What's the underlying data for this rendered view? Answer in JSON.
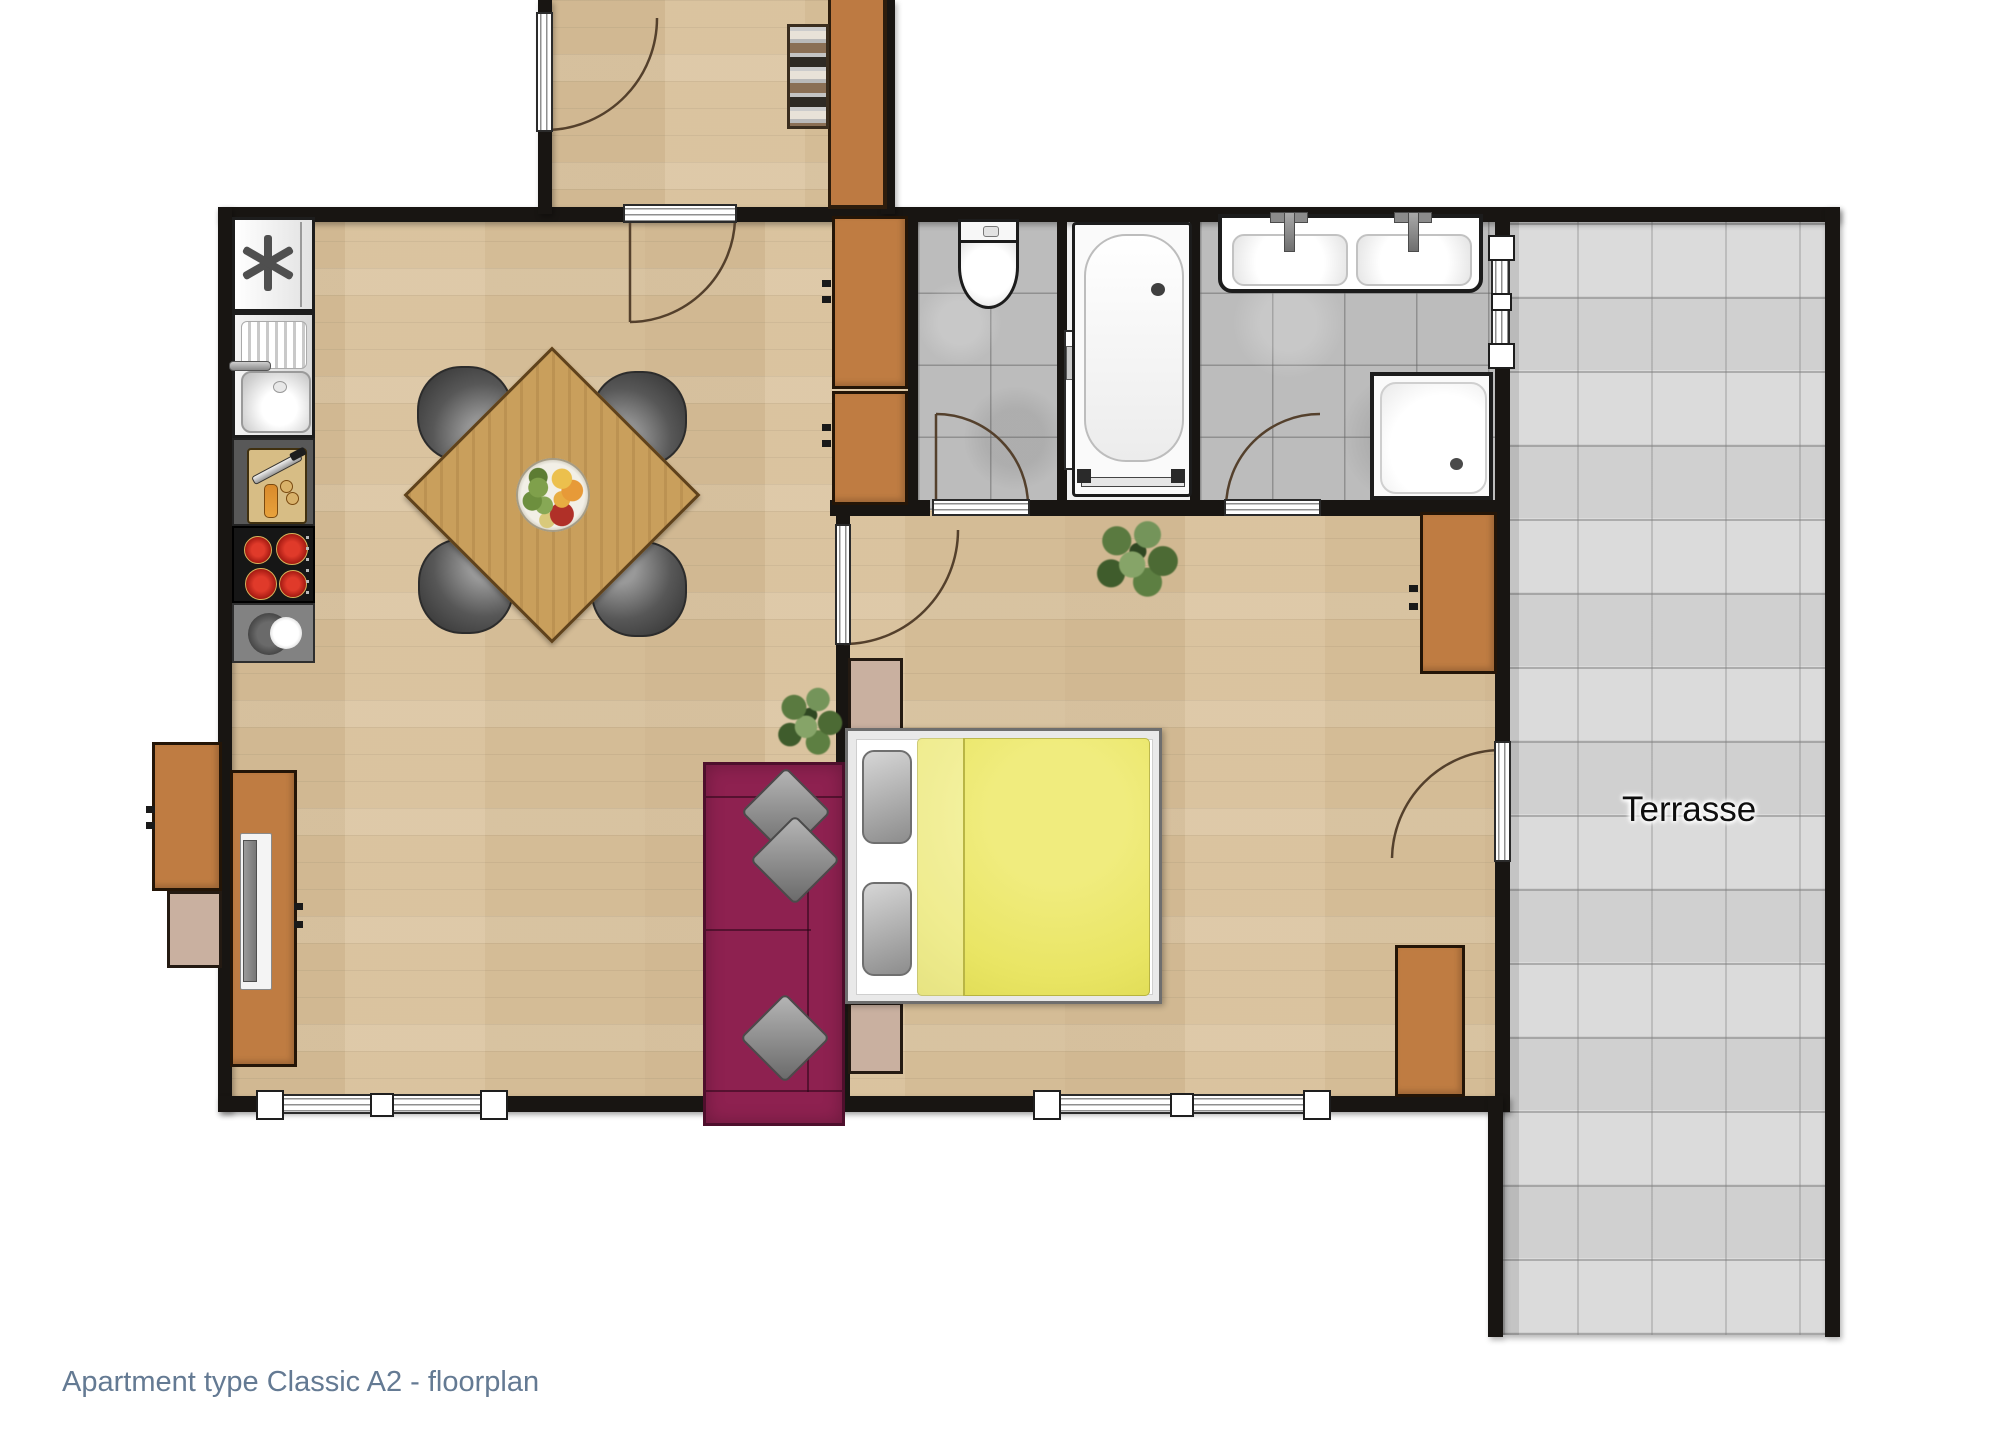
{
  "caption": {
    "text": "Apartment type Classic A2 - floorplan",
    "color": "#647a93"
  },
  "labels": {
    "terrace": "Terrasse"
  },
  "palette": {
    "wood_floor": "#d8c09a",
    "wall": "#181512",
    "cabinet_orange": "#bf7c42",
    "sofa_magenta": "#8e2150",
    "bed_blanket_yellow": "#e9e564",
    "bathroom_tile_gray": "#bcbcbc",
    "terrace_tile_gray": "#d7d7d7",
    "stove_burner_red": "#c32222",
    "kitchen_counter_gray": "#585858",
    "nightstand_beige": "#c9b0a0"
  },
  "rooms": [
    {
      "name": "entry-hallway"
    },
    {
      "name": "kitchen-living-dining"
    },
    {
      "name": "bedroom"
    },
    {
      "name": "toilet-room"
    },
    {
      "name": "bathtub-room"
    },
    {
      "name": "shower-washroom"
    },
    {
      "name": "terrace",
      "label": "Terrasse"
    }
  ],
  "furniture": [
    "fridge-freezer",
    "kitchen-sink",
    "cutting-board-counter",
    "stove-4-burners",
    "counter-with-bowl",
    "hall-shelf",
    "hall-cabinet",
    "closet-cabinets",
    "dining-table-with-fruit-bowl",
    "four-chairs",
    "tv-sideboard",
    "sofa-magenta",
    "double-bed-yellow-blanket",
    "two-nightstands",
    "toilet",
    "bathtub",
    "double-sink-vanity",
    "shower-tray",
    "wardrobe-cabinets-bedroom",
    "plants"
  ]
}
